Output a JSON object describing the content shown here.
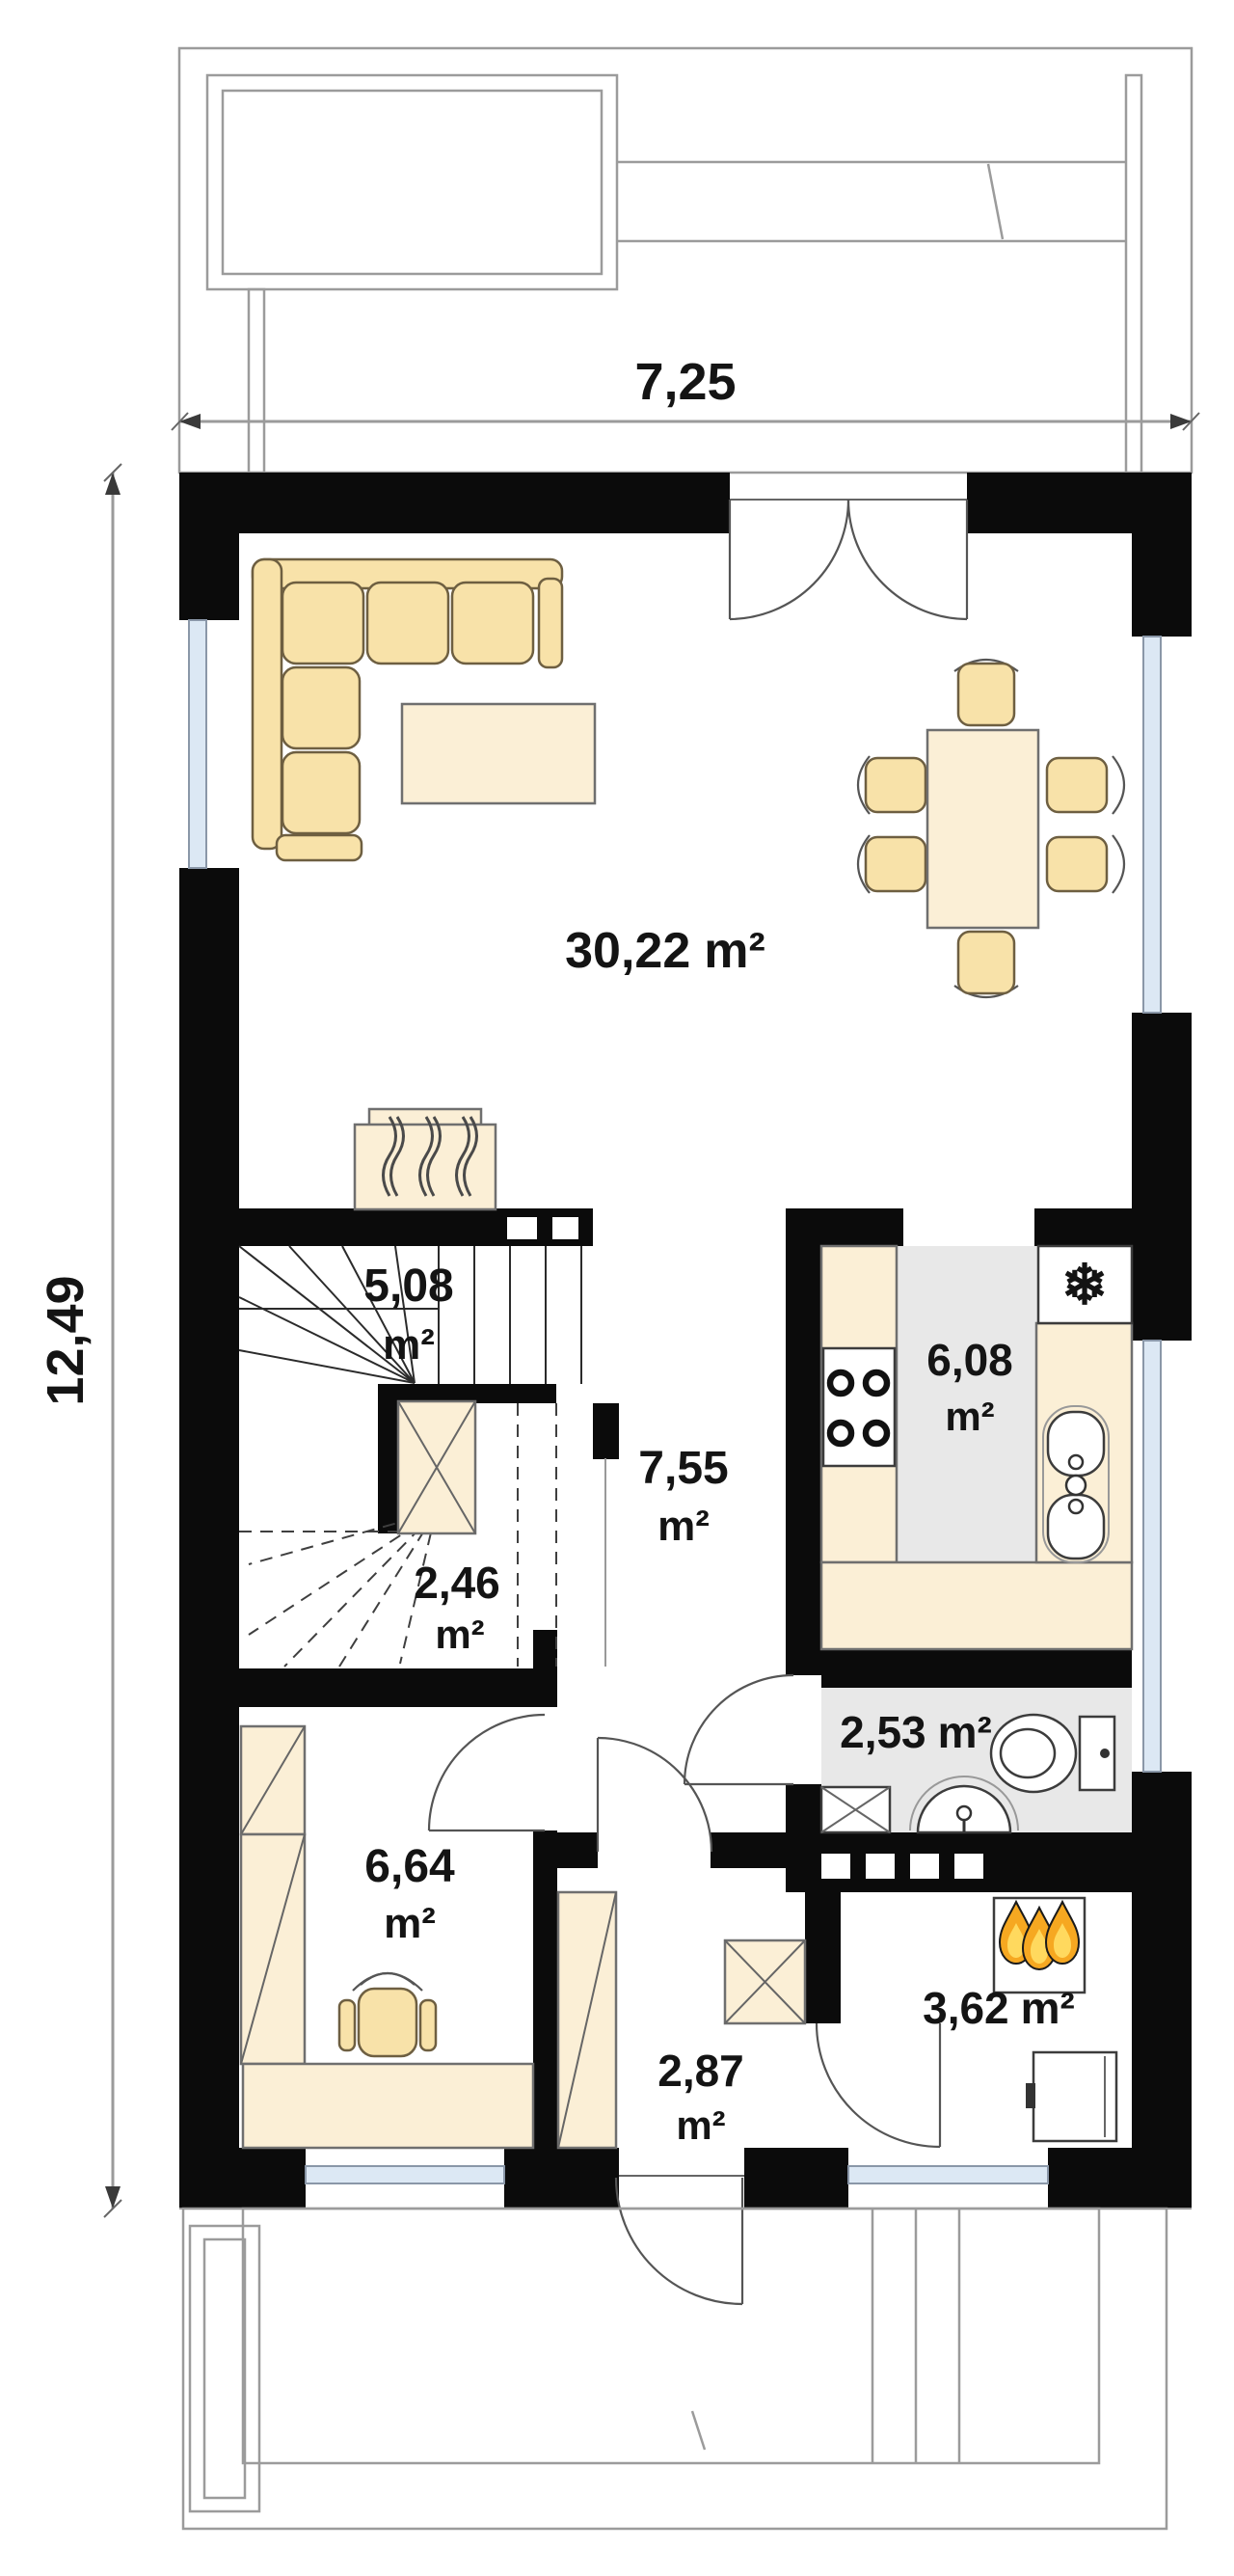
{
  "dimensions": {
    "width": "7,25",
    "depth": "12,49"
  },
  "rooms": {
    "living": {
      "value": "30,22",
      "unit": "m²"
    },
    "stairs": {
      "value": "5,08",
      "unit": "m²"
    },
    "closet": {
      "value": "2,46",
      "unit": "m²"
    },
    "hall": {
      "value": "7,55",
      "unit": "m²"
    },
    "kitchen": {
      "value": "6,08",
      "unit": "m²"
    },
    "wc": {
      "value": "2,53",
      "unit": "m²"
    },
    "office": {
      "value": "6,64",
      "unit": "m²"
    },
    "entry": {
      "value": "2,87",
      "unit": "m²"
    },
    "utility": {
      "value": "3,62",
      "unit": "m²"
    }
  },
  "icons": {
    "fridge_glyph": "❄"
  },
  "colors": {
    "wall": "#0b0b0b",
    "furniture_fill": "#f8e2a9",
    "furniture_light": "#fbefd6",
    "floor_gray": "#e8e8e8",
    "glazing": "#dce8f4",
    "flame_orange": "#f6a821",
    "flame_yellow": "#ffd95e",
    "line": "#666666",
    "dimension": "#9b9b9b"
  }
}
